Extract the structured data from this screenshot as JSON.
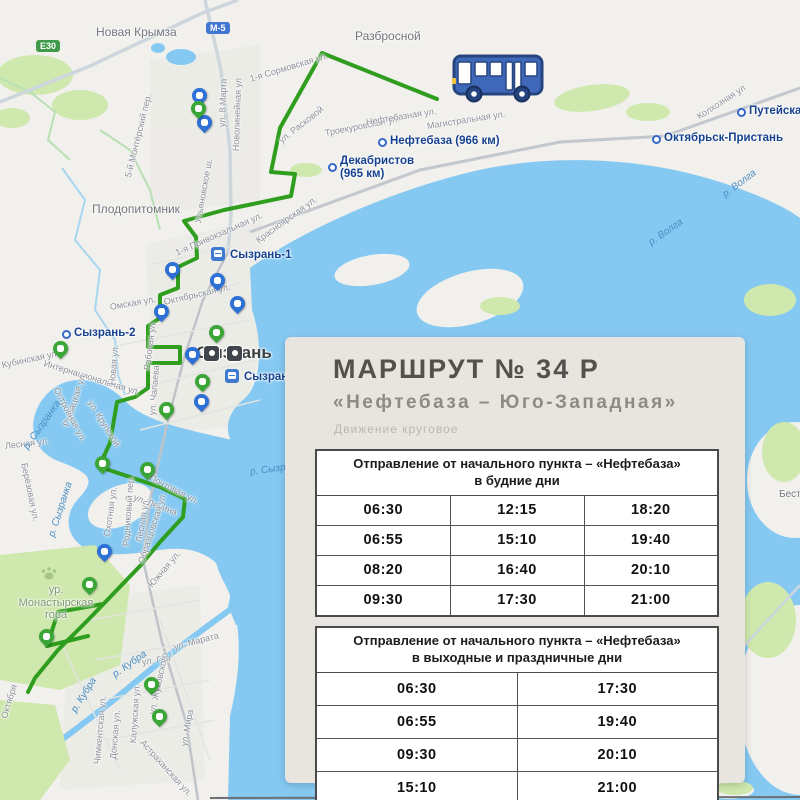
{
  "panel": {
    "title": "МАРШРУТ № 34 Р",
    "subtitle": "«Нефтебаза – Юго-Западная»",
    "note": "Движение круговое",
    "weekday": {
      "header": "Отправление от начального пункта – «Нефтебаза»\nв будние дни",
      "rows": [
        [
          "06:30",
          "12:15",
          "18:20"
        ],
        [
          "06:55",
          "15:10",
          "19:40"
        ],
        [
          "08:20",
          "16:40",
          "20:10"
        ],
        [
          "09:30",
          "17:30",
          "21:00"
        ]
      ]
    },
    "weekend": {
      "header": "Отправление от начального пункта – «Нефтебаза»\nв выходные и праздничные дни",
      "rows": [
        [
          "06:30",
          "17:30"
        ],
        [
          "06:55",
          "19:40"
        ],
        [
          "09:30",
          "20:10"
        ],
        [
          "15:10",
          "21:00"
        ]
      ]
    },
    "footer": "Город Сызрань"
  },
  "colors": {
    "route": "#2f9e1f",
    "water": "#85c9f2",
    "pin_blue": "#2d70d6",
    "pin_green": "#3aa636",
    "panel_bg": "#e8e4df",
    "title": "#53514c",
    "subtitle": "#8e8b84",
    "note": "#bbb8b0",
    "station_text": "#16418f",
    "street_text": "#8a9099",
    "water_text": "#4a8fc6"
  },
  "map": {
    "place_labels": [
      {
        "t": "Новая Крымза",
        "x": 96,
        "y": 26,
        "fs": 12
      },
      {
        "t": "Разбросной",
        "x": 355,
        "y": 30,
        "fs": 12
      },
      {
        "t": "Плодопитомник",
        "x": 92,
        "y": 203,
        "fs": 12
      },
      {
        "t": "Сызрань",
        "x": 196,
        "y": 343,
        "fs": 17,
        "w": 700,
        "c": "#3c4043"
      },
      {
        "t": "ур.\nМонастырская\nгора",
        "x": 12,
        "y": 584,
        "fs": 11,
        "c": "#7e9674",
        "wd": 88,
        "cen": 1
      },
      {
        "t": "Бест",
        "x": 779,
        "y": 489,
        "fs": 10
      }
    ],
    "station_labels": [
      {
        "t": "Сызрань-1",
        "x": 230,
        "y": 249,
        "icon": "rail",
        "ix": 211,
        "iy": 247
      },
      {
        "t": "Сызрань-город",
        "x": 244,
        "y": 371,
        "icon": "rail",
        "ix": 225,
        "iy": 369
      },
      {
        "t": "Сызрань-2",
        "x": 74,
        "y": 327,
        "icon": "ring",
        "ix": 62,
        "iy": 330
      },
      {
        "t": "Нефтебаза (966 км)",
        "x": 390,
        "y": 135,
        "icon": "ring",
        "ix": 378,
        "iy": 138
      },
      {
        "t": "Декабристов\n(965 км)",
        "x": 340,
        "y": 155,
        "icon": "ring",
        "ix": 328,
        "iy": 163
      },
      {
        "t": "Октябрьск-Пристань",
        "x": 664,
        "y": 132,
        "icon": "ring",
        "ix": 652,
        "iy": 135
      },
      {
        "t": "Путейская",
        "x": 749,
        "y": 105,
        "icon": "ring",
        "ix": 737,
        "iy": 108
      }
    ],
    "road_badges": [
      {
        "t": "Е30",
        "x": 36,
        "y": 40,
        "bg": "#3e9b49"
      },
      {
        "t": "М-5",
        "x": 206,
        "y": 22,
        "bg": "#4276d3"
      }
    ],
    "street_labels": [
      {
        "t": "1-я Сормовская ул.",
        "x": 250,
        "y": 74,
        "r": -17
      },
      {
        "t": "ул. Расковой",
        "x": 280,
        "y": 136,
        "r": -38
      },
      {
        "t": "Троекуровская ул.",
        "x": 325,
        "y": 128,
        "r": -11
      },
      {
        "t": "Нефтебазная ул.",
        "x": 366,
        "y": 117,
        "r": -9
      },
      {
        "t": "Магистральная ул.",
        "x": 427,
        "y": 121,
        "r": -9
      },
      {
        "t": "Колхозная ул",
        "x": 698,
        "y": 112,
        "r": -33
      },
      {
        "t": "5-й Монтёрский пер.",
        "x": 128,
        "y": 172,
        "r": -76
      },
      {
        "t": "Новолинейная ул",
        "x": 236,
        "y": 146,
        "r": -88
      },
      {
        "t": "ул. 8 Марта",
        "x": 222,
        "y": 122,
        "r": -88
      },
      {
        "t": "Ульяновское ш.",
        "x": 198,
        "y": 218,
        "r": -80
      },
      {
        "t": "Красноярская ул.",
        "x": 257,
        "y": 236,
        "r": -36
      },
      {
        "t": "1-я Привокзальная ул.",
        "x": 176,
        "y": 248,
        "r": -24
      },
      {
        "t": "Октябрьская ул.",
        "x": 164,
        "y": 297,
        "r": -13
      },
      {
        "t": "Омская ул.",
        "x": 110,
        "y": 302,
        "r": -10
      },
      {
        "t": "Рабочая ул.",
        "x": 147,
        "y": 365,
        "r": -83
      },
      {
        "t": "ул. Чапаева",
        "x": 152,
        "y": 410,
        "r": -85
      },
      {
        "t": "Интернациональная ул.",
        "x": 44,
        "y": 358,
        "r": 17
      },
      {
        "t": "Кубинская ул.",
        "x": 2,
        "y": 360,
        "r": -12
      },
      {
        "t": "Новая ул.",
        "x": 112,
        "y": 380,
        "r": -85
      },
      {
        "t": "Рыбацкая ул.",
        "x": 66,
        "y": 421,
        "r": -72
      },
      {
        "t": "ул. Крупской",
        "x": 90,
        "y": 396,
        "r": 58
      },
      {
        "t": "Островная ул.",
        "x": 56,
        "y": 383,
        "r": 62
      },
      {
        "t": "Лесная ул.",
        "x": 5,
        "y": 441,
        "r": -7
      },
      {
        "t": "Берёзовая ул.",
        "x": 24,
        "y": 458,
        "r": 78
      },
      {
        "t": "Охотная ул.",
        "x": 107,
        "y": 531,
        "r": -82
      },
      {
        "t": "Родниковый пер.",
        "x": 126,
        "y": 541,
        "r": -86
      },
      {
        "t": "Лесная ул.",
        "x": 139,
        "y": 537,
        "r": -81
      },
      {
        "t": "Почтовая ул.",
        "x": 150,
        "y": 472,
        "r": 27
      },
      {
        "t": "ул. Ленина",
        "x": 134,
        "y": 492,
        "r": 20
      },
      {
        "t": "Образцовская ул.",
        "x": 141,
        "y": 558,
        "r": -72
      },
      {
        "t": "Южная ул.",
        "x": 150,
        "y": 581,
        "r": -50
      },
      {
        "t": "ул. Марата",
        "x": 174,
        "y": 642,
        "r": -15
      },
      {
        "t": "ул. Гая",
        "x": 142,
        "y": 657,
        "r": -8
      },
      {
        "t": "ул. Жуковского",
        "x": 152,
        "y": 709,
        "r": -78
      },
      {
        "t": "ул. Мира",
        "x": 184,
        "y": 741,
        "r": -80
      },
      {
        "t": "Калужская ул.",
        "x": 133,
        "y": 738,
        "r": -86
      },
      {
        "t": "Астраханская ул.",
        "x": 142,
        "y": 736,
        "r": 48
      },
      {
        "t": "Донская ул.",
        "x": 113,
        "y": 754,
        "r": -85
      },
      {
        "t": "Чимкентская ул.",
        "x": 97,
        "y": 759,
        "r": -85
      },
      {
        "t": "Октября",
        "x": 4,
        "y": 713,
        "r": -73
      }
    ],
    "water_labels": [
      {
        "t": "р. Волга",
        "x": 724,
        "y": 190,
        "r": -37
      },
      {
        "t": "р. Волга",
        "x": 650,
        "y": 238,
        "r": -35
      },
      {
        "t": "р. Сызранка",
        "x": 26,
        "y": 443,
        "r": -55
      },
      {
        "t": "р. Сызранка",
        "x": 52,
        "y": 531,
        "r": -72
      },
      {
        "t": "р. Сызранка",
        "x": 250,
        "y": 467,
        "r": -8
      },
      {
        "t": "р. Кубра",
        "x": 74,
        "y": 706,
        "r": -58
      },
      {
        "t": "р. Кубра",
        "x": 114,
        "y": 670,
        "r": -35
      }
    ],
    "pins": [
      {
        "x": 200,
        "y": 104,
        "c": "blue",
        "n": "bus-stop-pin"
      },
      {
        "x": 205,
        "y": 131,
        "c": "blue",
        "n": "bus-stop-pin"
      },
      {
        "x": 173,
        "y": 278,
        "c": "blue",
        "n": "bus-stop-pin"
      },
      {
        "x": 218,
        "y": 289,
        "c": "blue",
        "n": "bus-stop-pin"
      },
      {
        "x": 238,
        "y": 312,
        "c": "blue",
        "n": "bus-stop-pin"
      },
      {
        "x": 162,
        "y": 320,
        "c": "blue",
        "n": "bus-stop-pin"
      },
      {
        "x": 193,
        "y": 363,
        "c": "blue",
        "n": "bus-stop-pin"
      },
      {
        "x": 202,
        "y": 410,
        "c": "blue",
        "n": "bus-stop-pin"
      },
      {
        "x": 105,
        "y": 560,
        "c": "blue",
        "n": "bus-stop-pin"
      },
      {
        "x": 199,
        "y": 117,
        "c": "green",
        "n": "route-stop-pin"
      },
      {
        "x": 217,
        "y": 341,
        "c": "green",
        "n": "route-stop-pin"
      },
      {
        "x": 203,
        "y": 390,
        "c": "green",
        "n": "courthouse-poi-pin"
      },
      {
        "x": 167,
        "y": 418,
        "c": "green",
        "n": "route-stop-pin"
      },
      {
        "x": 103,
        "y": 472,
        "c": "green",
        "n": "route-stop-pin"
      },
      {
        "x": 148,
        "y": 478,
        "c": "green",
        "n": "route-stop-pin"
      },
      {
        "x": 61,
        "y": 357,
        "c": "green",
        "n": "park-poi-pin"
      },
      {
        "x": 90,
        "y": 593,
        "c": "green",
        "n": "route-stop-pin"
      },
      {
        "x": 47,
        "y": 645,
        "c": "green",
        "n": "route-stop-pin"
      },
      {
        "x": 152,
        "y": 693,
        "c": "green",
        "n": "route-stop-pin"
      },
      {
        "x": 160,
        "y": 725,
        "c": "green",
        "n": "route-stop-pin"
      }
    ],
    "poi": [
      {
        "x": 203,
        "y": 345,
        "n": "museum-poi-icon"
      },
      {
        "x": 226,
        "y": 345,
        "n": "camera-poi-icon"
      }
    ]
  }
}
